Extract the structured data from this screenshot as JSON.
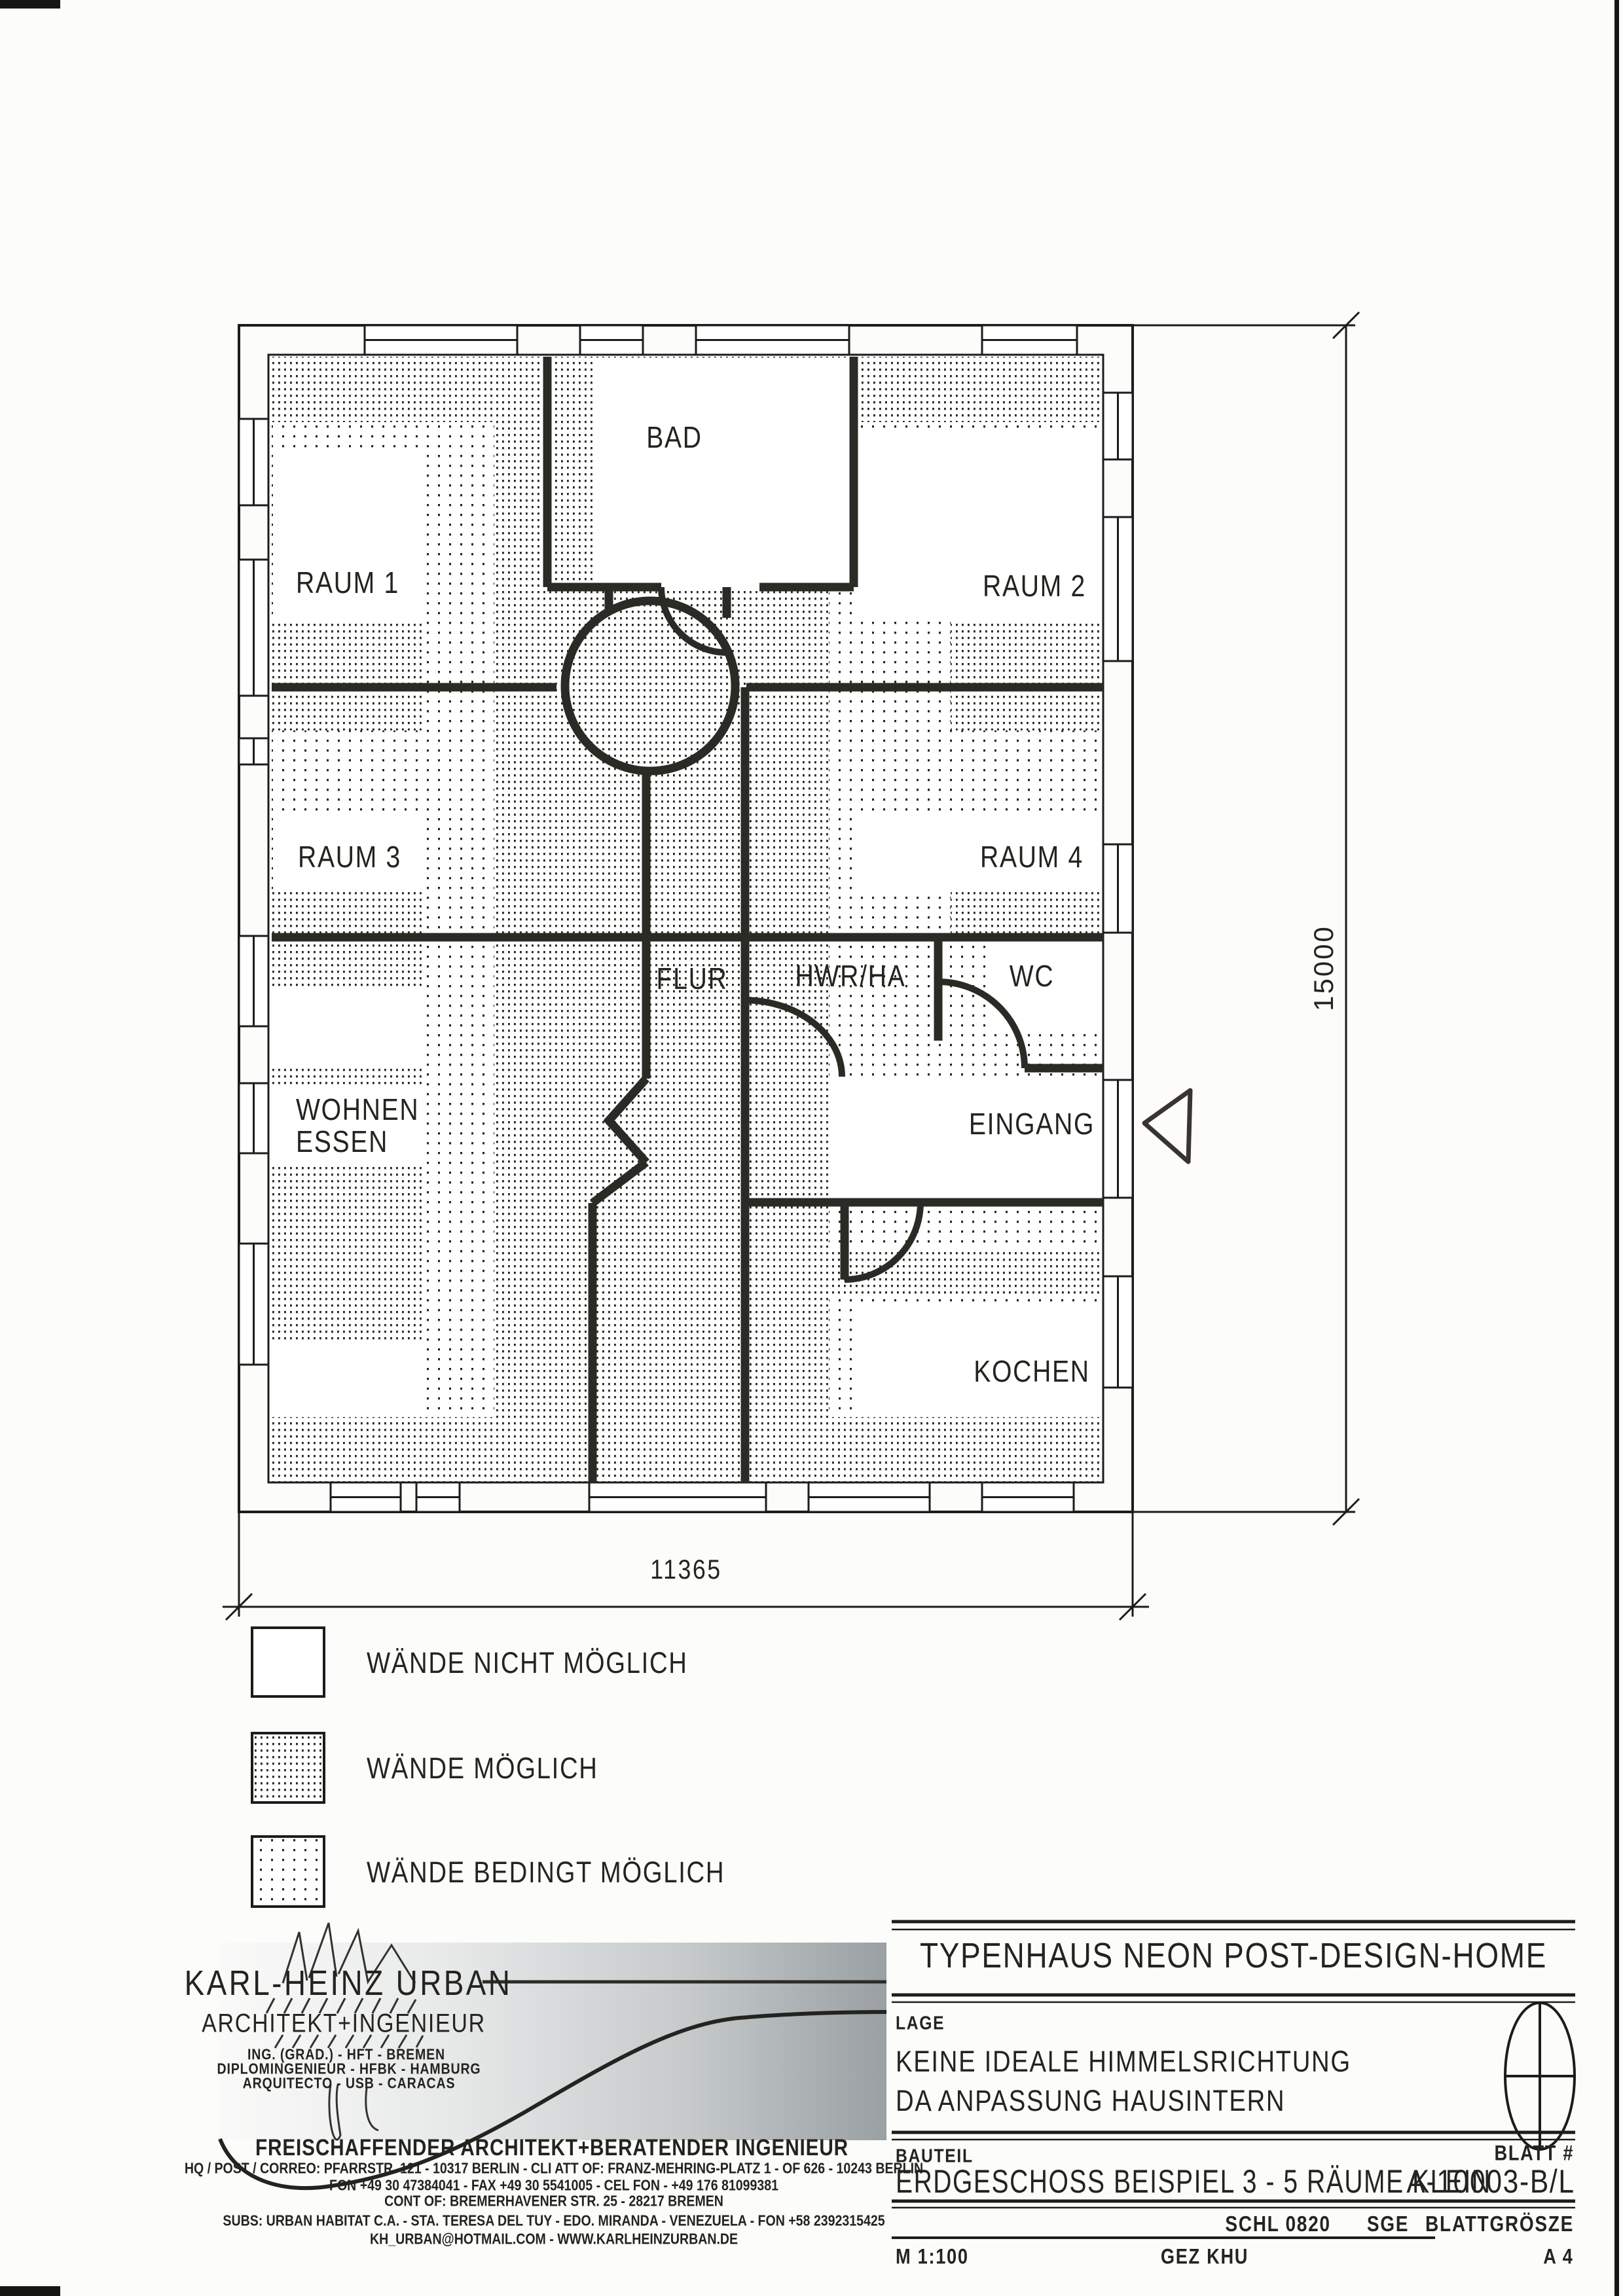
{
  "plan": {
    "rooms": {
      "bad": "BAD",
      "raum1": "RAUM 1",
      "raum2": "RAUM 2",
      "raum3": "RAUM 3",
      "raum4": "RAUM 4",
      "flur": "FLUR",
      "hwr": "HWR/HA",
      "wc": "WC",
      "wohnen_line1": "WOHNEN",
      "wohnen_line2": "ESSEN",
      "eingang": "EINGANG",
      "kochen": "KOCHEN"
    },
    "dimensions": {
      "width": "11365",
      "height": "15000"
    }
  },
  "legend": {
    "items": [
      {
        "label": "WÄNDE NICHT MÖGLICH",
        "pattern": "none"
      },
      {
        "label": "WÄNDE MÖGLICH",
        "pattern": "dense-dots"
      },
      {
        "label": "WÄNDE BEDINGT MÖGLICH",
        "pattern": "sparse-dots"
      }
    ]
  },
  "architect": {
    "name": "KARL-HEINZ URBAN",
    "title": "ARCHITEKT+INGENIEUR",
    "credential1": "ING. (GRAD.) - HFT - BREMEN",
    "credential2": "DIPLOMINGENIEUR - HFBK - HAMBURG",
    "credential3": "ARQUITECTO - USB - CARACAS",
    "tagline": "FREISCHAFFENDER ARCHITEKT+BERATENDER INGENIEUR",
    "address_line1": "HQ / POST / CORREO: PFARRSTR. 121 - 10317 BERLIN - CLI ATT OF: FRANZ-MEHRING-PLATZ 1 - OF 626 - 10243 BERLIN",
    "address_line2": "FON +49 30 47384041 - FAX +49 30 5541005 - CEL FON - +49 176 81099381",
    "address_line3": "CONT OF: BREMERHAVENER STR. 25 - 28217 BREMEN",
    "address_line4": "SUBS: URBAN HABITAT C.A. - STA. TERESA DEL TUY - EDO. MIRANDA - VENEZUELA - FON +58 2392315425",
    "address_line5": "KH_URBAN@HOTMAIL.COM  -  WWW.KARLHEINZURBAN.DE"
  },
  "titleblock": {
    "project": "TYPENHAUS NEON POST-DESIGN-HOME",
    "lage_label": "LAGE",
    "lage_line1": "KEINE IDEALE HIMMELSRICHTUNG",
    "lage_line2": "DA ANPASSUNG HAUSINTERN",
    "bauteil_label": "BAUTEIL",
    "blatt_label": "BLATT #",
    "bauteil_value": "ERDGESCHOSS BEISPIEL 3 - 5 RÄUME KLEIN",
    "blatt_value": "A-10003-B/L",
    "schl": "SCHL 0820",
    "sge": "SGE",
    "blattgroesze_label": "BLATTGRÖSZE",
    "massstab": "M 1:100",
    "gezeichnet": "GEZ KHU",
    "blattformat": "A 4"
  }
}
